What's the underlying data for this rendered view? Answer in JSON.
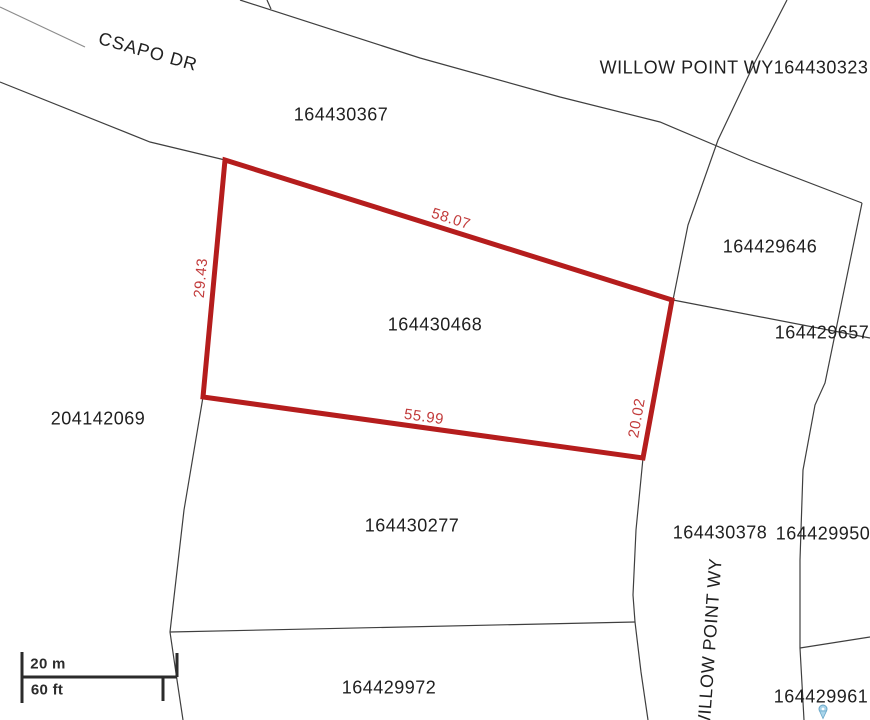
{
  "map": {
    "colors": {
      "background": "#ffffff",
      "boundary_line": "#3f3f3f",
      "highlight_outline": "#b51d1d",
      "dimension_text": "#c23b3b",
      "label_text": "#1f1f1f",
      "marker_fill": "#a8d4ea",
      "marker_stroke": "#6aa7c8"
    },
    "highlight": {
      "parcel_id": "164430468",
      "dimensions": [
        {
          "text": "58.07",
          "x": 451,
          "y": 219,
          "rotate": 17.5
        },
        {
          "text": "29.43",
          "x": 201,
          "y": 278,
          "rotate": -85
        },
        {
          "text": "55.99",
          "x": 424,
          "y": 417,
          "rotate": 8
        },
        {
          "text": "20.02",
          "x": 637,
          "y": 418,
          "rotate": -80
        }
      ]
    },
    "street_labels": [
      {
        "text": "CSAPO DR",
        "x": 148,
        "y": 52,
        "rotate": 15.5,
        "spacing": 1
      },
      {
        "text": "WILLOW POINT WY164430323",
        "x": 734,
        "y": 68,
        "rotate": 0
      },
      {
        "text": "WILLOW POINT WY",
        "x": 710,
        "y": 645,
        "rotate": -86
      }
    ],
    "parcel_labels": [
      {
        "text": "164430367",
        "x": 341,
        "y": 115
      },
      {
        "text": "164429646",
        "x": 770,
        "y": 247
      },
      {
        "text": "164429657",
        "x": 822,
        "y": 333
      },
      {
        "text": "164430468",
        "x": 435,
        "y": 325
      },
      {
        "text": "204142069",
        "x": 98,
        "y": 419
      },
      {
        "text": "164430277",
        "x": 412,
        "y": 526
      },
      {
        "text": "164430378",
        "x": 720,
        "y": 533
      },
      {
        "text": "164429950",
        "x": 823,
        "y": 534
      },
      {
        "text": "164429972",
        "x": 389,
        "y": 688
      },
      {
        "text": "164429961",
        "x": 821,
        "y": 697
      }
    ],
    "scale_bar": {
      "metric_label": "20 m",
      "imperial_label": "60 ft"
    }
  }
}
